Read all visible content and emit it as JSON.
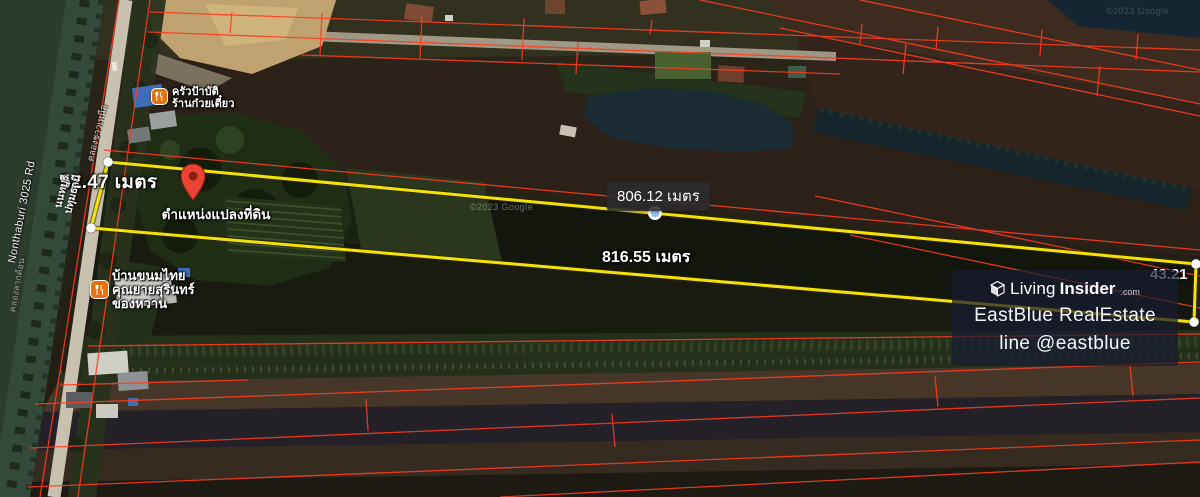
{
  "map": {
    "attribution": "©2023 Google",
    "measurements": {
      "left": "52.47 เมตร",
      "top": "806.12 เมตร",
      "bottom": "816.55 เมตร",
      "right": "43.21"
    },
    "pin": {
      "label": "ตำแหน่งแปลงที่ดิน"
    },
    "pois": [
      {
        "lines": [
          "ครัวป้าบัติ",
          "ร้านก๋วยเตี๋ยว"
        ]
      },
      {
        "lines": [
          "บ้านขนมไทย",
          "คุณยายสุรินทร์",
          "ของหวาน"
        ]
      }
    ],
    "roads": {
      "en": "Nonthaburi 3025 Rd",
      "th1": "นนทบุรี",
      "th2": "ปทุมธานี"
    },
    "canals": {
      "c1": "คลองชาวเหนือ",
      "c2": "คลองลากค้อน"
    }
  },
  "watermark": {
    "living": "Living",
    "insider": "Insider",
    "tld": ".com",
    "line1": "EastBlue RealEstate",
    "line2": "line @eastblue"
  },
  "colors": {
    "measure_line": "#f2e208",
    "parcel_line": "#ff3b1f",
    "poi": "#e8710a",
    "pin": "#ea4335",
    "midpoint_dot": "#8ec2f2"
  }
}
